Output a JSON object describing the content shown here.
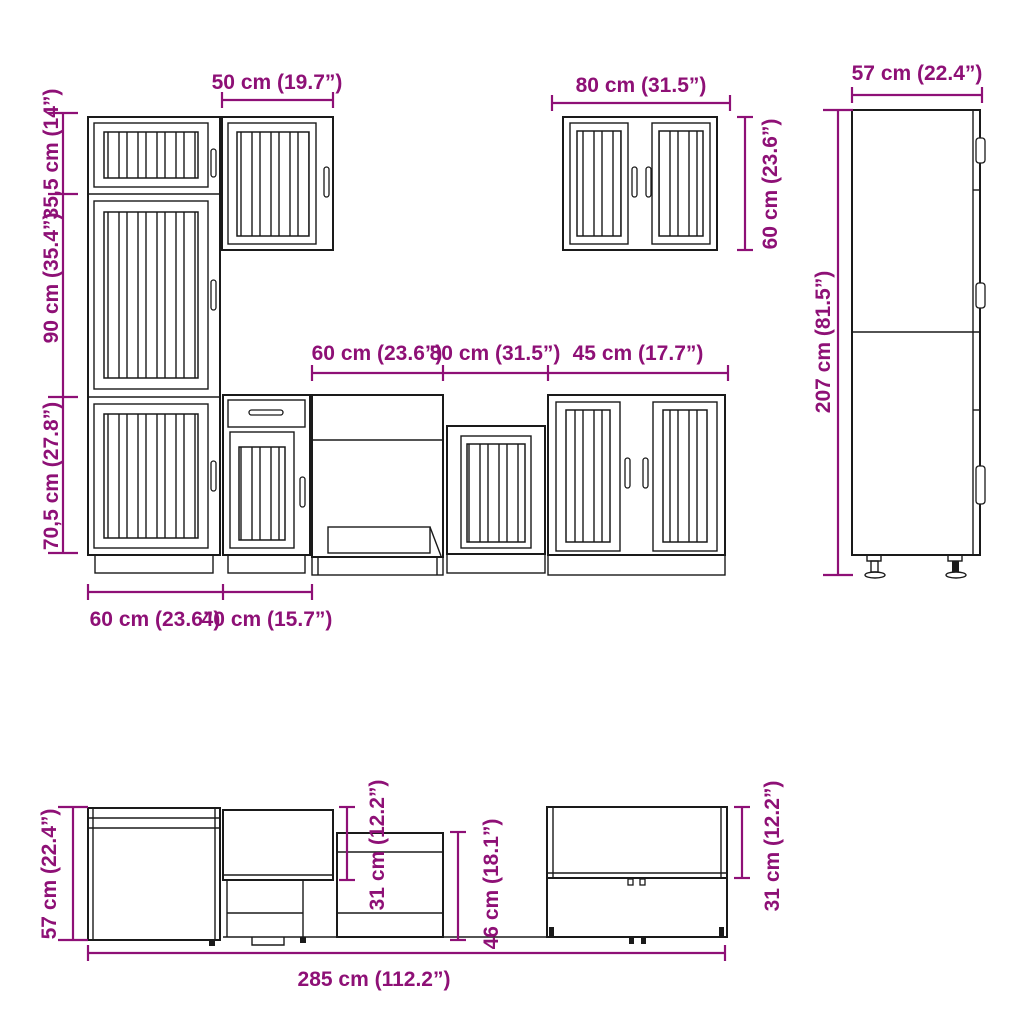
{
  "diagram": {
    "accent_color": "#8E1076",
    "line_color": "#1a1a1a",
    "front_view": {
      "wall50_width": "50 cm (19.7”)",
      "tall_top_height": "35,5 cm (14”)",
      "tall_mid_height": "90 cm (35.4”)",
      "tall_low_height": "70,5 cm (27.8”)",
      "base60_width": "60 cm (23.6”)",
      "base40_width": "40 cm (15.7”)",
      "run60_width": "60 cm (23.6”)",
      "run80_width": "80 cm (31.5”)",
      "run45_width": "45 cm (17.7”)",
      "wall80_width": "80 cm (31.5”)",
      "wall80_height": "60 cm (23.6”)",
      "tall57_width": "57 cm (22.4”)",
      "tall207_height": "207 cm (81.5”)"
    },
    "plan_view": {
      "depth57": "57 cm (22.4”)",
      "wall_depth_left": "31 cm (12.2”)",
      "depth46": "46 cm (18.1”)",
      "wall_depth_right": "31 cm (12.2”)",
      "total285": "285 cm (112.2”)"
    }
  }
}
